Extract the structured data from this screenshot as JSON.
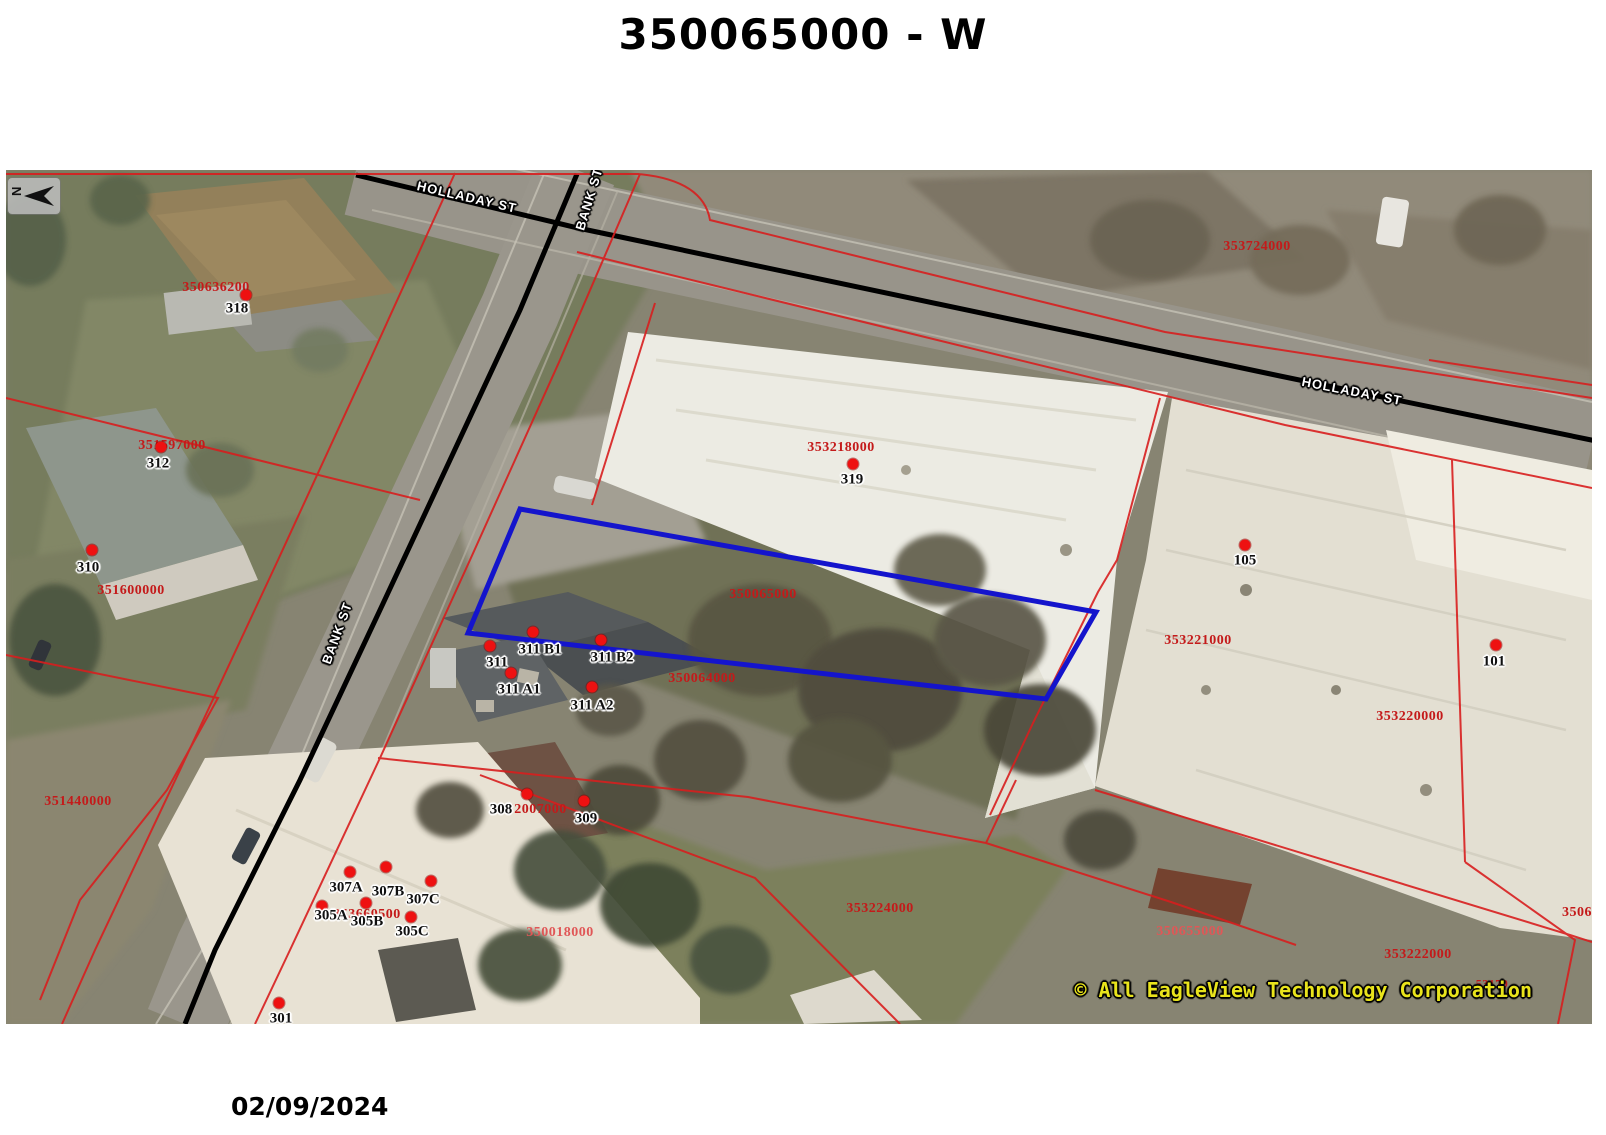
{
  "title": "350065000 - W",
  "date": "02/09/2024",
  "copyright": "© All EagleView Technology Corporation",
  "north": {
    "label": "N"
  },
  "colors": {
    "parcel_line": "#d81e1e",
    "parcel_label_red": "#c41a1a",
    "parcel_label_pink": "#e05757",
    "subject_outline_blue": "#1414cc",
    "road_centerline": "#000000",
    "address_dot": "#ee1111",
    "copyright_yellow": "#e9e41c"
  },
  "subject_parcel": {
    "id": "350065000"
  },
  "streets": [
    {
      "name": "HOLLADAY ST",
      "x": 467,
      "y": 197,
      "rot": 13
    },
    {
      "name": "BANK ST",
      "x": 589,
      "y": 199,
      "rot": -73
    },
    {
      "name": "HOLLADAY ST",
      "x": 1352,
      "y": 391,
      "rot": 11
    },
    {
      "name": "BANK ST",
      "x": 337,
      "y": 633,
      "rot": -70
    }
  ],
  "parcel_labels": [
    {
      "text": "350636200",
      "x": 216,
      "y": 288,
      "tone": "red"
    },
    {
      "text": "351597000",
      "x": 172,
      "y": 446,
      "tone": "red"
    },
    {
      "text": "351600000",
      "x": 131,
      "y": 591,
      "tone": "red"
    },
    {
      "text": "351440000",
      "x": 78,
      "y": 802,
      "tone": "red"
    },
    {
      "text": "353724000",
      "x": 1257,
      "y": 247,
      "tone": "red"
    },
    {
      "text": "353218000",
      "x": 841,
      "y": 448,
      "tone": "red"
    },
    {
      "text": "350065000",
      "x": 763,
      "y": 595,
      "tone": "red"
    },
    {
      "text": "350064000",
      "x": 702,
      "y": 679,
      "tone": "red"
    },
    {
      "text": "353221000",
      "x": 1198,
      "y": 641,
      "tone": "red"
    },
    {
      "text": "353220000",
      "x": 1410,
      "y": 717,
      "tone": "red"
    },
    {
      "text": "353660500",
      "x": 367,
      "y": 915,
      "tone": "red"
    },
    {
      "text": "352007000",
      "x": 533,
      "y": 810,
      "tone": "red"
    },
    {
      "text": "350018000",
      "x": 560,
      "y": 933,
      "tone": "pink"
    },
    {
      "text": "353224000",
      "x": 880,
      "y": 909,
      "tone": "red"
    },
    {
      "text": "350655000",
      "x": 1190,
      "y": 932,
      "tone": "pink"
    },
    {
      "text": "353222000",
      "x": 1418,
      "y": 955,
      "tone": "red"
    },
    {
      "text": "350629000",
      "x": 1562,
      "y": 913,
      "tone": "red",
      "anchor": "left"
    },
    {
      "text": "53179",
      "x": 1492,
      "y": 984,
      "tone": "red",
      "small": true
    }
  ],
  "addresses": [
    {
      "text": "318",
      "x": 237,
      "y": 309,
      "dx": 246,
      "dy": 295
    },
    {
      "text": "312",
      "x": 158,
      "y": 464,
      "dx": 161,
      "dy": 447
    },
    {
      "text": "310",
      "x": 88,
      "y": 568,
      "dx": 92,
      "dy": 550
    },
    {
      "text": "319",
      "x": 852,
      "y": 480,
      "dx": 853,
      "dy": 464
    },
    {
      "text": "105",
      "x": 1245,
      "y": 561,
      "dx": 1245,
      "dy": 545
    },
    {
      "text": "101",
      "x": 1494,
      "y": 662,
      "dx": 1496,
      "dy": 645
    },
    {
      "text": "311",
      "x": 497,
      "y": 663,
      "dx": 490,
      "dy": 646
    },
    {
      "text": "311 B1",
      "x": 540,
      "y": 650,
      "dx": 533,
      "dy": 632
    },
    {
      "text": "311 B2",
      "x": 612,
      "y": 658,
      "dx": 601,
      "dy": 640
    },
    {
      "text": "311 A1",
      "x": 519,
      "y": 690,
      "dx": 511,
      "dy": 673
    },
    {
      "text": "311 A2",
      "x": 592,
      "y": 706,
      "dx": 592,
      "dy": 687
    },
    {
      "text": "307A",
      "x": 346,
      "y": 888,
      "dx": 350,
      "dy": 872
    },
    {
      "text": "307B",
      "x": 388,
      "y": 892,
      "dx": 386,
      "dy": 867
    },
    {
      "text": "307C",
      "x": 423,
      "y": 900,
      "dx": 431,
      "dy": 881
    },
    {
      "text": "305A",
      "x": 331,
      "y": 916,
      "dx": 322,
      "dy": 906
    },
    {
      "text": "305B",
      "x": 367,
      "y": 922,
      "dx": 366,
      "dy": 903
    },
    {
      "text": "305C",
      "x": 412,
      "y": 932,
      "dx": 411,
      "dy": 917
    },
    {
      "text": "301",
      "x": 281,
      "y": 1019,
      "dx": 279,
      "dy": 1003
    },
    {
      "text": "308",
      "x": 501,
      "y": 810,
      "dx": 527,
      "dy": 794
    },
    {
      "text": "309",
      "x": 586,
      "y": 819,
      "dx": 584,
      "dy": 801
    }
  ]
}
